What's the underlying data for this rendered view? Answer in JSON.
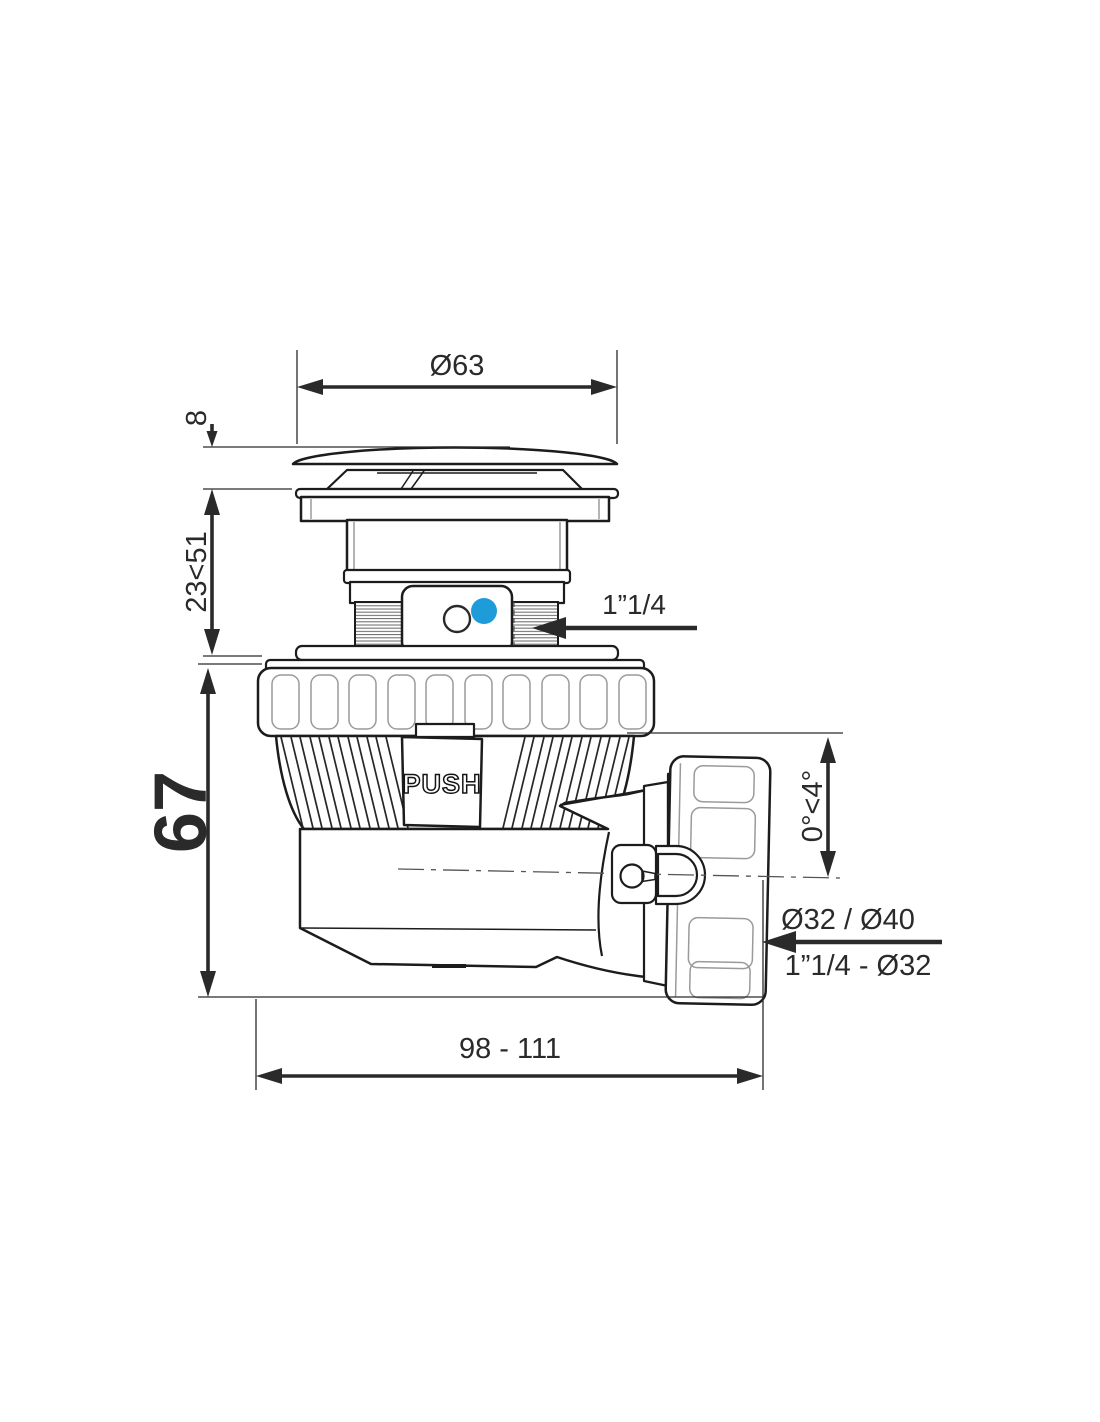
{
  "labels": {
    "cap_diameter": "Ø63",
    "cap_height": "8",
    "adjust_range": "23<51",
    "body_height": "67",
    "push": "PUSH",
    "inlet_thread": "1”1/4",
    "angle_range": "0°<4°",
    "outlet_diameters": "Ø32 / Ø40",
    "outlet_thread": "1”1/4 - Ø32",
    "overall_length": "98 - 111"
  },
  "colors": {
    "line": "#1c1c1c",
    "dimension": "#2a2a2a",
    "accent_blue": "#1e9cd9",
    "background": "#ffffff"
  }
}
